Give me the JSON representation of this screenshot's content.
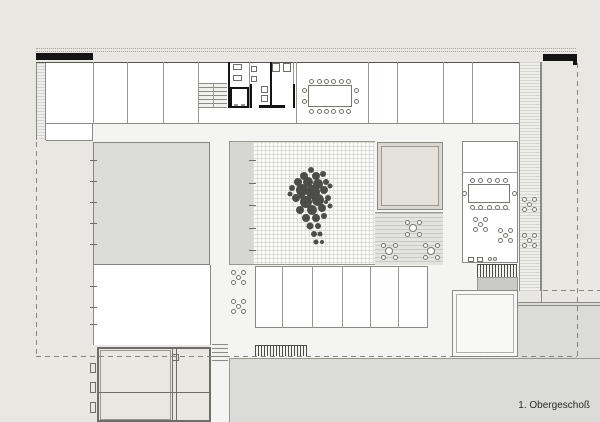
{
  "caption": {
    "label": "1. Obergeschoß"
  },
  "palette": {
    "background": "#e9e7e2",
    "room_fill": "#ffffff",
    "circulation_fill": "#f4f4f2",
    "roof_gray": "#dcdcda",
    "terrace_gray": "#dbdbd8",
    "courtyard_strip_gray": "#d6d6d3",
    "skylight_fill": "#e4e1d9",
    "wall_black": "#141414",
    "line_gray": "#8a8a86",
    "tree_color": "#3c3c37"
  },
  "furniture": {
    "conference_tables": [
      {
        "id": "north-conference-table",
        "x": 308,
        "y": 85,
        "w": 44,
        "h": 22,
        "chairs": {
          "top": 6,
          "bottom": 6,
          "left": 2,
          "right": 2
        }
      },
      {
        "id": "east-meeting-table",
        "x": 468,
        "y": 184,
        "w": 42,
        "h": 19,
        "chairs": {
          "top": 5,
          "bottom": 5,
          "left": 1,
          "right": 1
        }
      }
    ],
    "round_tables": [
      {
        "x": 413,
        "y": 228
      },
      {
        "x": 389,
        "y": 251
      },
      {
        "x": 431,
        "y": 251
      }
    ],
    "seat_clusters": [
      {
        "x": 529,
        "y": 204
      },
      {
        "x": 529,
        "y": 240
      },
      {
        "x": 480,
        "y": 224
      },
      {
        "x": 505,
        "y": 235
      },
      {
        "x": 238,
        "y": 277
      },
      {
        "x": 238,
        "y": 306
      }
    ],
    "single_seats": [
      {
        "x": 490,
        "y": 259
      },
      {
        "x": 495,
        "y": 259
      }
    ]
  },
  "structure": {
    "upper_partitions": {
      "xs": [
        93,
        127,
        163,
        198,
        368,
        397,
        443,
        472
      ],
      "y0": 62,
      "y1": 124
    },
    "south_partitions": {
      "xs": [
        282,
        312,
        342,
        370,
        398
      ],
      "y0": 266,
      "y1": 328
    },
    "left_edge_ticks": {
      "x": 90,
      "ys": [
        160,
        181,
        202,
        223,
        244,
        286,
        307,
        324
      ]
    },
    "courtyard_ticks": {
      "x": 249,
      "ys": [
        160,
        183,
        205,
        228,
        250
      ]
    }
  }
}
